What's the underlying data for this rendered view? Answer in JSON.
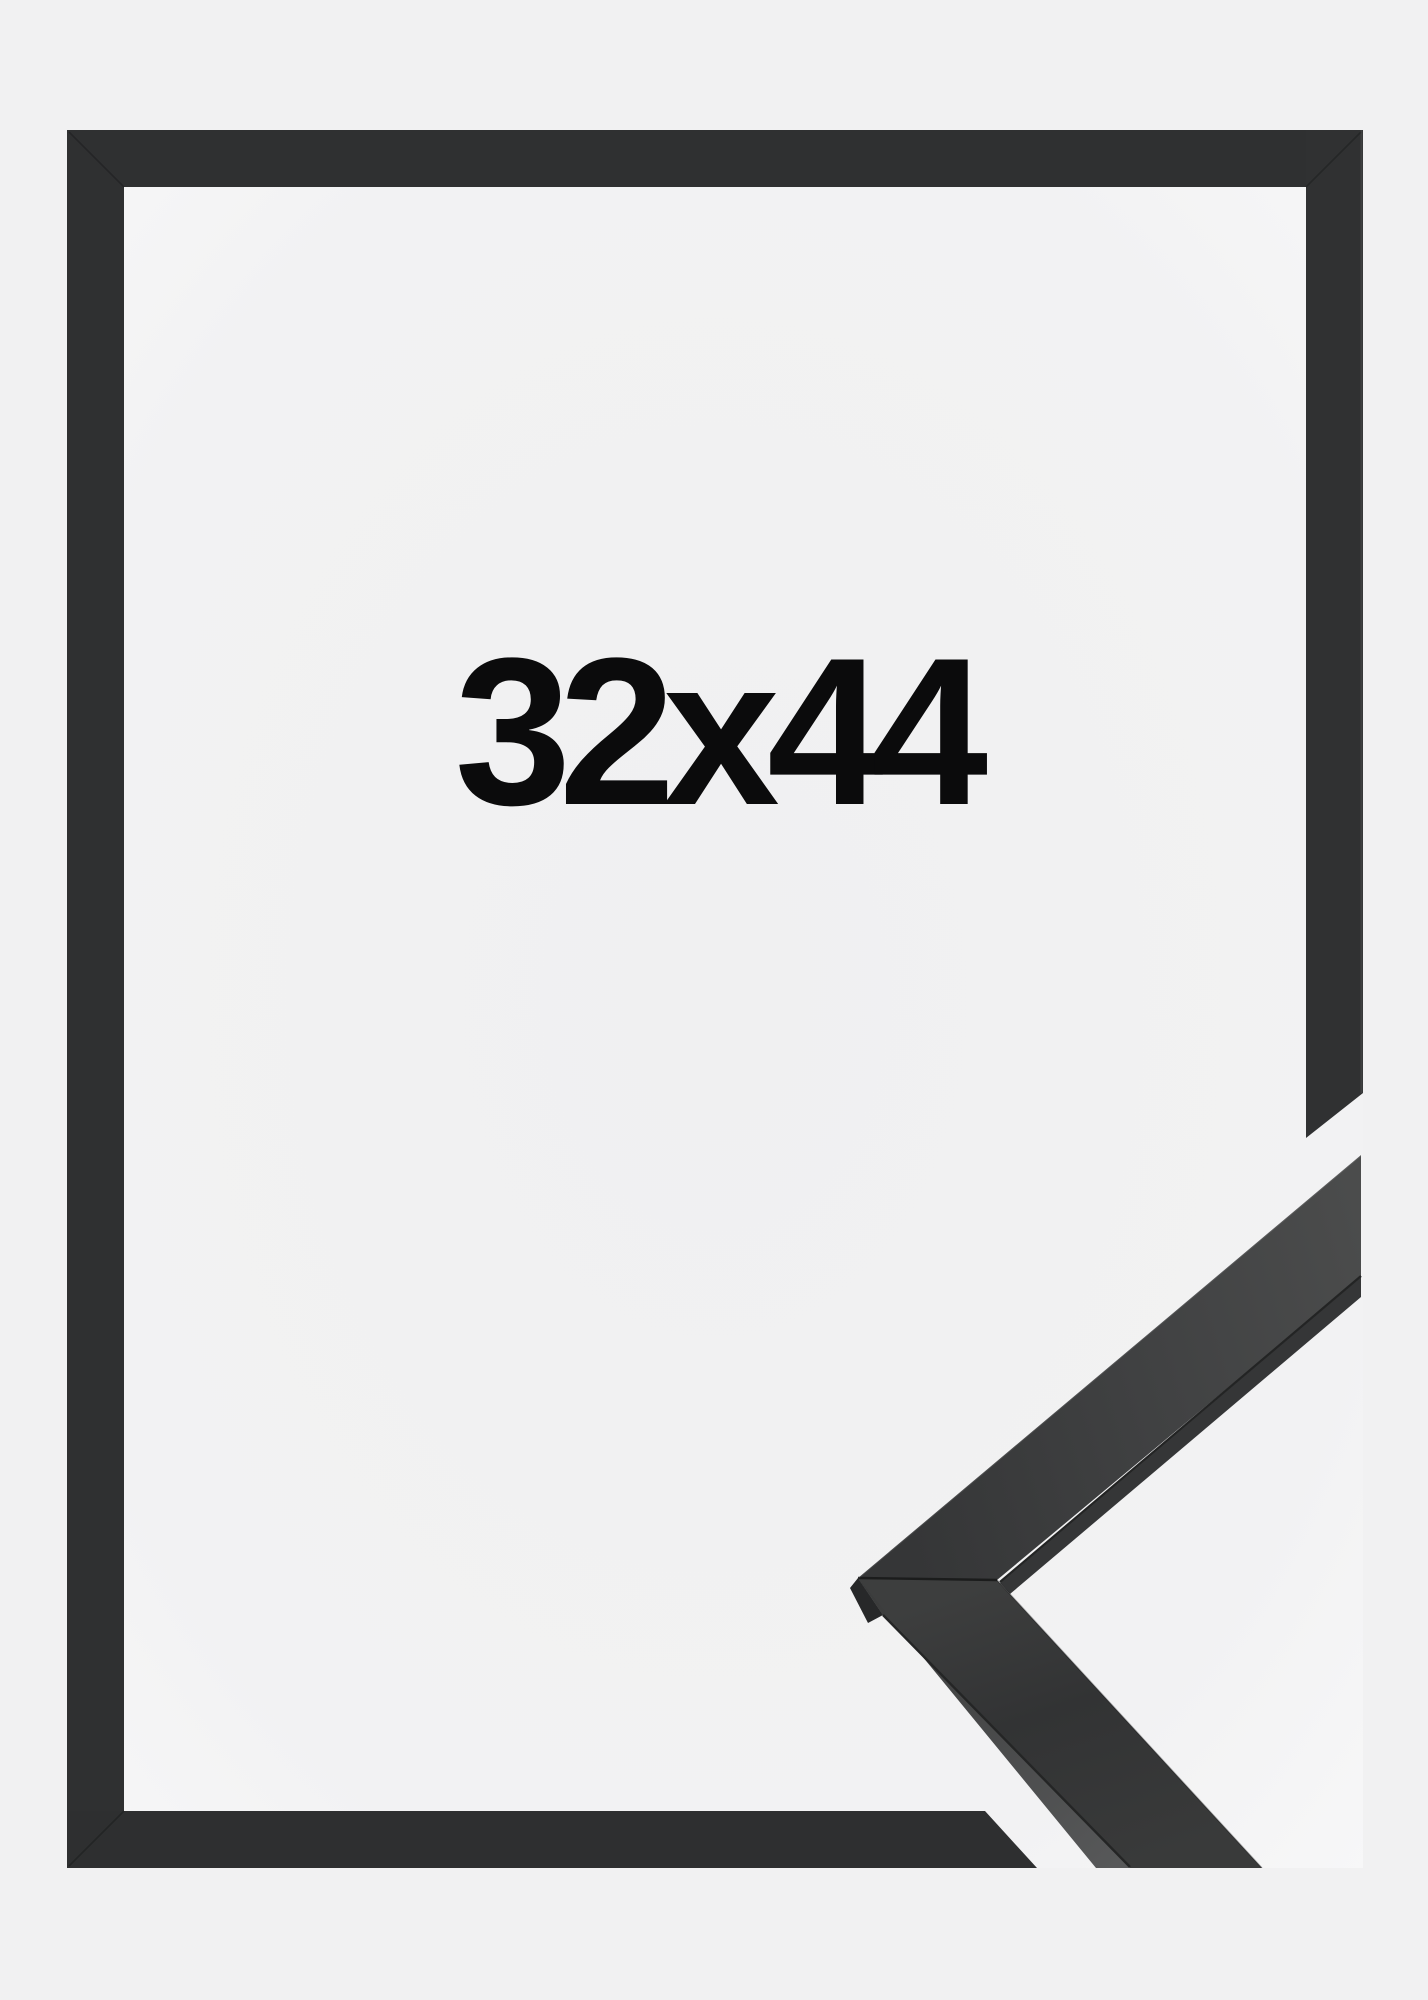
{
  "product_photo": {
    "size_label": "32x44"
  },
  "colors": {
    "page_background": "#f1f1f2",
    "photo_background_center": "#f0f0f1",
    "photo_background_edge": "#f8f8f9",
    "frame_moulding": "#2f3031",
    "sample_face_dark": "#343536",
    "sample_face_light": "#4b4c4c",
    "sample_side_edge_light": "#5a5b5c",
    "sample_end_face": "#272829",
    "label_text": "#0b0b0c"
  }
}
